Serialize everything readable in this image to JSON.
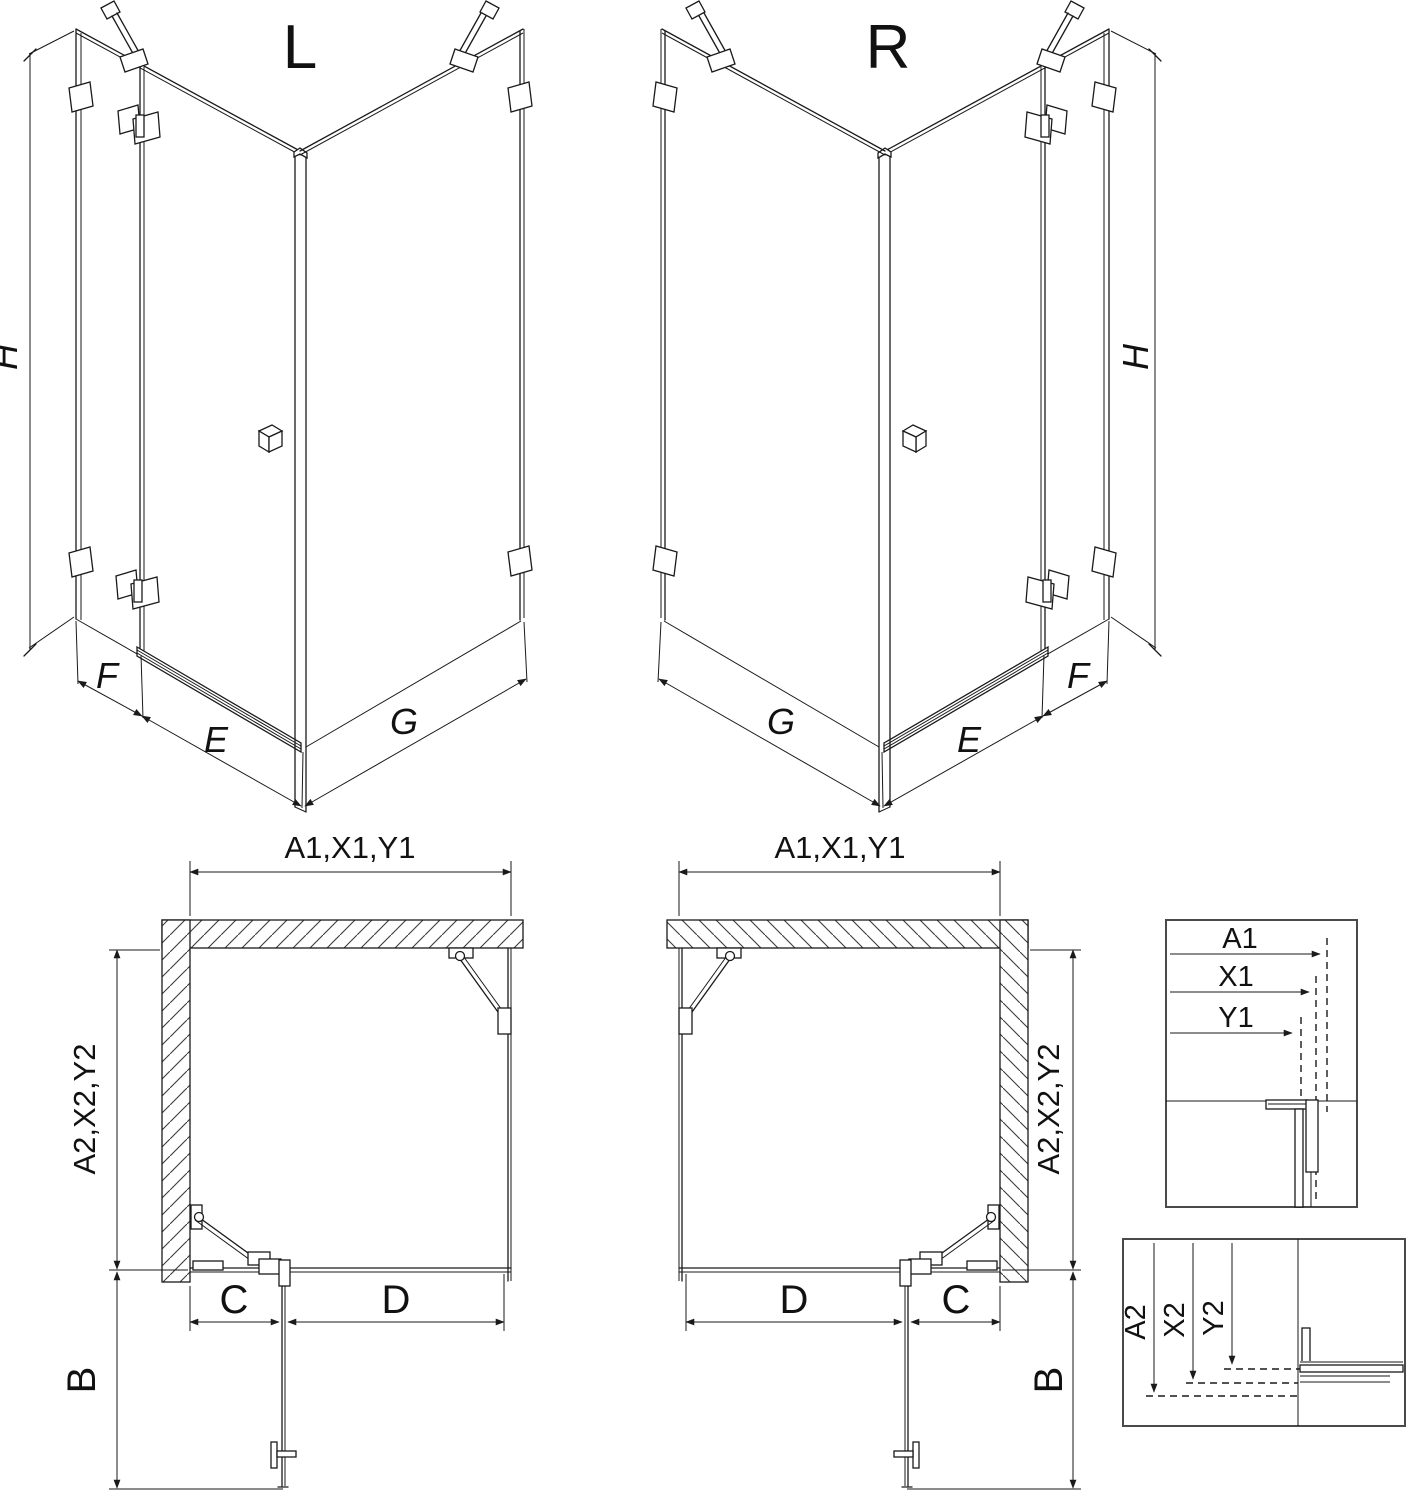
{
  "colors": {
    "line": "#1a1a1a",
    "profile_gray": "#8a8a8a",
    "hatch": "#3a3a3a",
    "background": "#ffffff"
  },
  "iso_views": {
    "left": {
      "title": "L",
      "height_label": "H",
      "fixed_panel_label": "F",
      "door_bottom_label": "E",
      "side_wall_label": "G"
    },
    "right": {
      "title": "R",
      "height_label": "H",
      "fixed_panel_label": "F",
      "door_bottom_label": "E",
      "side_wall_label": "G"
    }
  },
  "plan_views": {
    "left": {
      "width_dim": "A1,X1,Y1",
      "depth_dim": "A2,X2,Y2",
      "fixed_segment": "C",
      "door_segment": "D",
      "door_projection": "B"
    },
    "right": {
      "width_dim": "A1,X1,Y1",
      "depth_dim": "A2,X2,Y2",
      "fixed_segment": "C",
      "door_segment": "D",
      "door_projection": "B"
    }
  },
  "detail_views": {
    "width_detail": {
      "labels": [
        "A1",
        "X1",
        "Y1"
      ]
    },
    "depth_detail": {
      "labels": [
        "A2",
        "X2",
        "Y2"
      ]
    }
  }
}
